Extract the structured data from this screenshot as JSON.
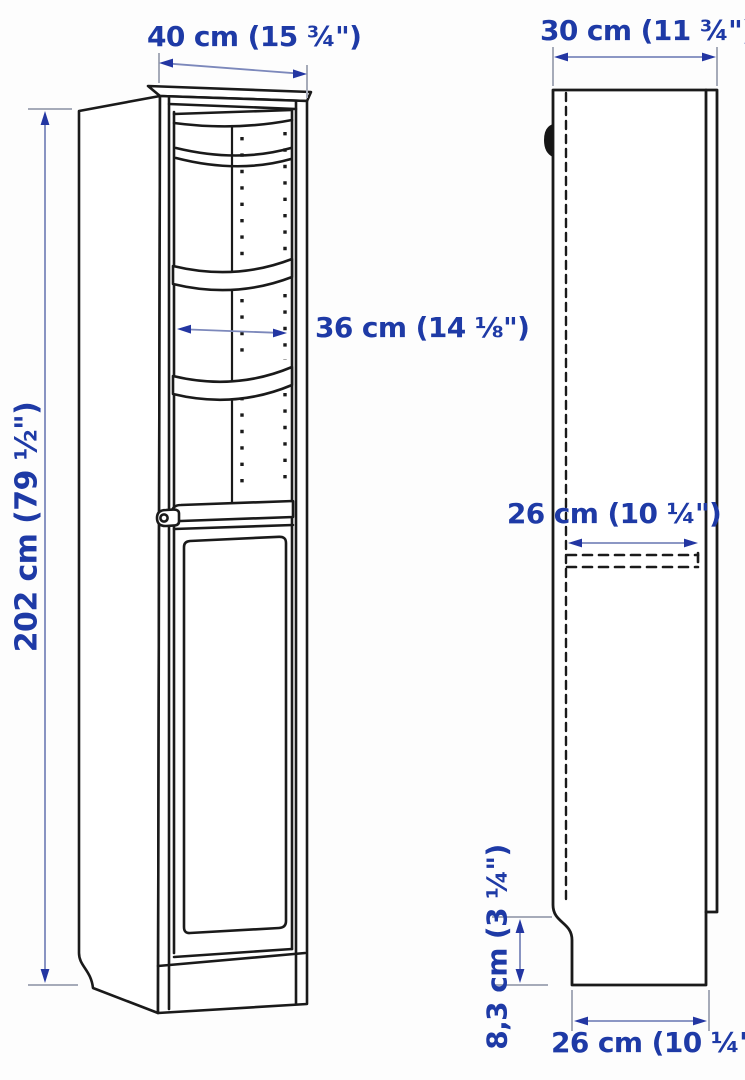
{
  "diagram": {
    "type": "product-dimension-drawing",
    "views": {
      "front": "front view of tall cabinet with glass door top and panel door bottom",
      "side": "side profile view of cabinet"
    },
    "labels": {
      "front_width": "40 cm (15 ¾\")",
      "top_depth": "30 cm (11 ¾\")",
      "height": "202 cm (79 ½\")",
      "interior_width": "36 cm (14 ⅛\")",
      "shelf_depth": "26 cm (10 ¼\")",
      "plinth_height": "8,3 cm (3 ¼\")",
      "base_depth": "26 cm (10 ¼\")"
    },
    "colors": {
      "label_text": "#1e3aa6",
      "dimension_line": "#7c88bb",
      "arrowhead": "#2336a2",
      "extension_tick": "#a6abb9",
      "drawing_line": "#1a1a1a",
      "background": "#fdfdfd"
    }
  }
}
